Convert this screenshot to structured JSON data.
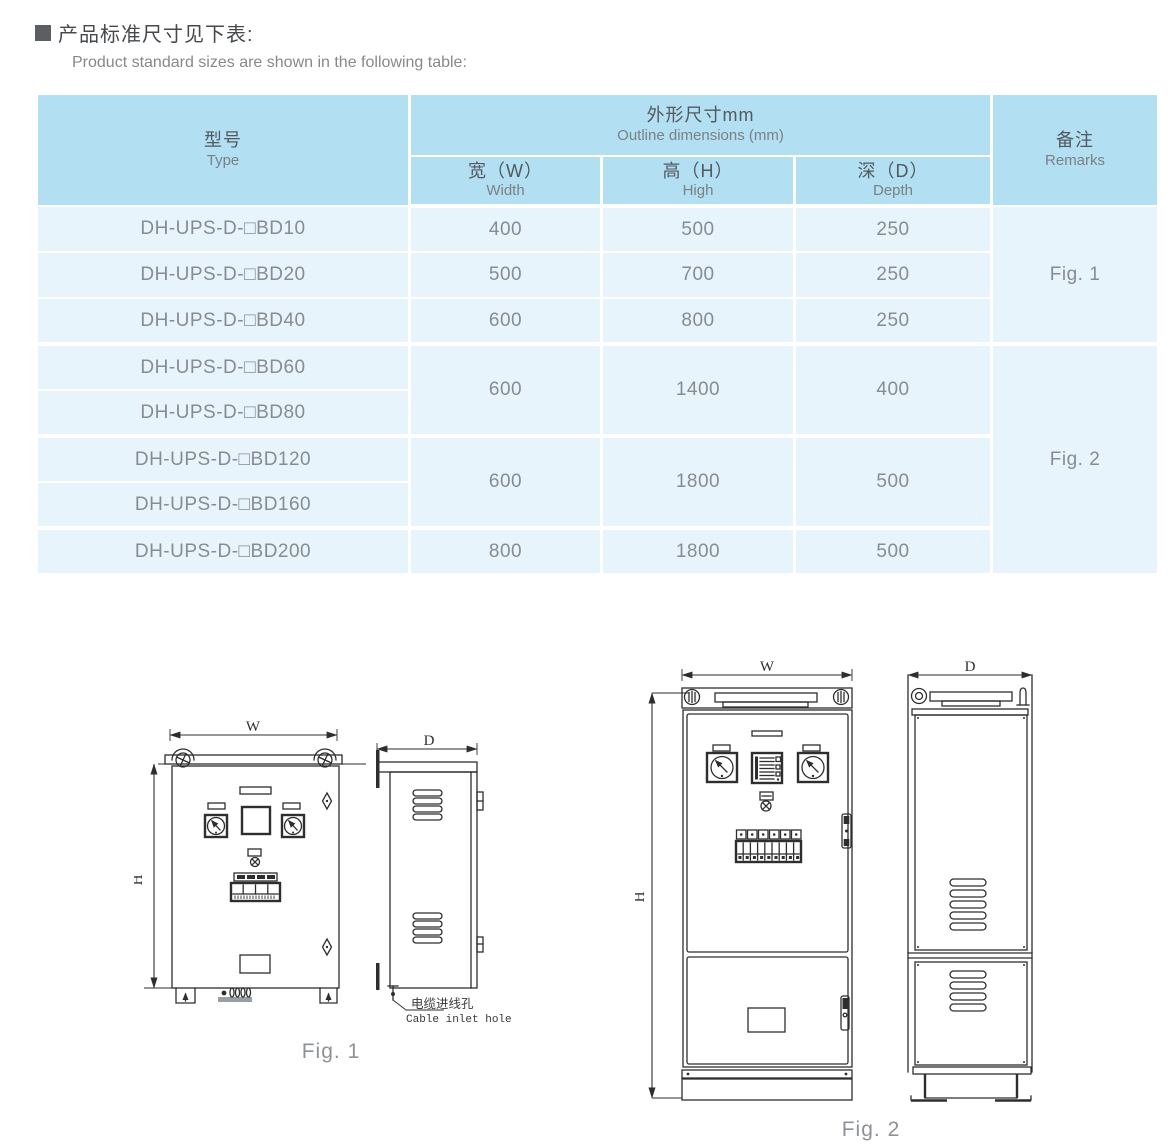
{
  "header": {
    "title_zh": "产品标准尺寸见下表:",
    "title_en": "Product standard sizes are shown in the following table:"
  },
  "table": {
    "header": {
      "type": {
        "zh": "型号",
        "en": "Type"
      },
      "dims": {
        "zh": "外形尺寸mm",
        "en": "Outline dimensions (mm)"
      },
      "w": {
        "zh": "宽（W）",
        "en": "Width"
      },
      "h": {
        "zh": "高（H）",
        "en": "High"
      },
      "d": {
        "zh": "深（D）",
        "en": "Depth"
      },
      "remarks": {
        "zh": "备注",
        "en": "Remarks"
      }
    },
    "rows": [
      {
        "model": "DH-UPS-D-□BD10",
        "w": "400",
        "h": "500",
        "d": "250"
      },
      {
        "model": "DH-UPS-D-□BD20",
        "w": "500",
        "h": "700",
        "d": "250"
      },
      {
        "model": "DH-UPS-D-□BD40",
        "w": "600",
        "h": "800",
        "d": "250"
      },
      {
        "model": "DH-UPS-D-□BD60",
        "w": "600",
        "h": "1400",
        "d": "400"
      },
      {
        "model": "DH-UPS-D-□BD80"
      },
      {
        "model": "DH-UPS-D-□BD120",
        "w": "600",
        "h": "1800",
        "d": "500"
      },
      {
        "model": "DH-UPS-D-□BD160"
      },
      {
        "model": "DH-UPS-D-□BD200",
        "w": "800",
        "h": "1800",
        "d": "500"
      }
    ],
    "remarks": {
      "fig1": "Fig. 1",
      "fig2": "Fig. 2"
    }
  },
  "fig1": {
    "caption": "Fig. 1",
    "dims": {
      "w": "W",
      "h": "H",
      "d": "D"
    },
    "callout": {
      "zh": "电缆进线孔",
      "en": "Cable inlet hole"
    }
  },
  "fig2": {
    "caption": "Fig. 2",
    "dims": {
      "w": "W",
      "h": "H",
      "d": "D"
    }
  },
  "colors": {
    "table_header_bg": "#b2dff2",
    "table_row_bg": "#e7f4fb",
    "divider": "#ffffff",
    "body_text": "#878c90",
    "drawing_line": "#2e2e2e",
    "caption_text": "#8e9296"
  }
}
